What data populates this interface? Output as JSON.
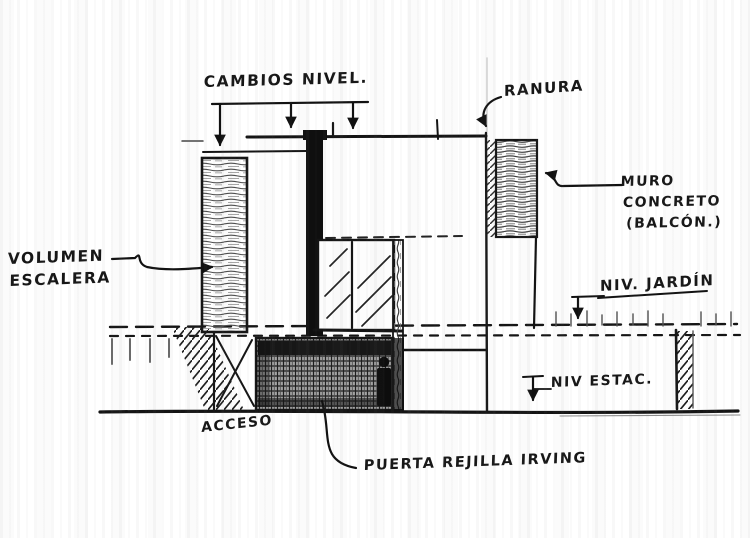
{
  "drawing": {
    "kind": "hand-drawn architectural section sketch",
    "labels": {
      "cambios_nivel": "CAMBIOS NIVEL.",
      "ranura": "RANURA",
      "muro_line1": "MURO",
      "muro_line2": "CONCRETO",
      "muro_line3": "(BALCÓN.)",
      "niv_jardin": "NIV. JARDÍN",
      "niv_estac": "NIV ESTAC.",
      "volumen_line1": "VOLUMEN",
      "volumen_line2": "ESCALERA",
      "acceso": "ACCESO",
      "puerta_rejilla": "PUERTA REJILLA IRVING"
    },
    "colors": {
      "ink": "#141414",
      "pencil": "#4d4d4d",
      "paper": "#ffffff"
    }
  }
}
